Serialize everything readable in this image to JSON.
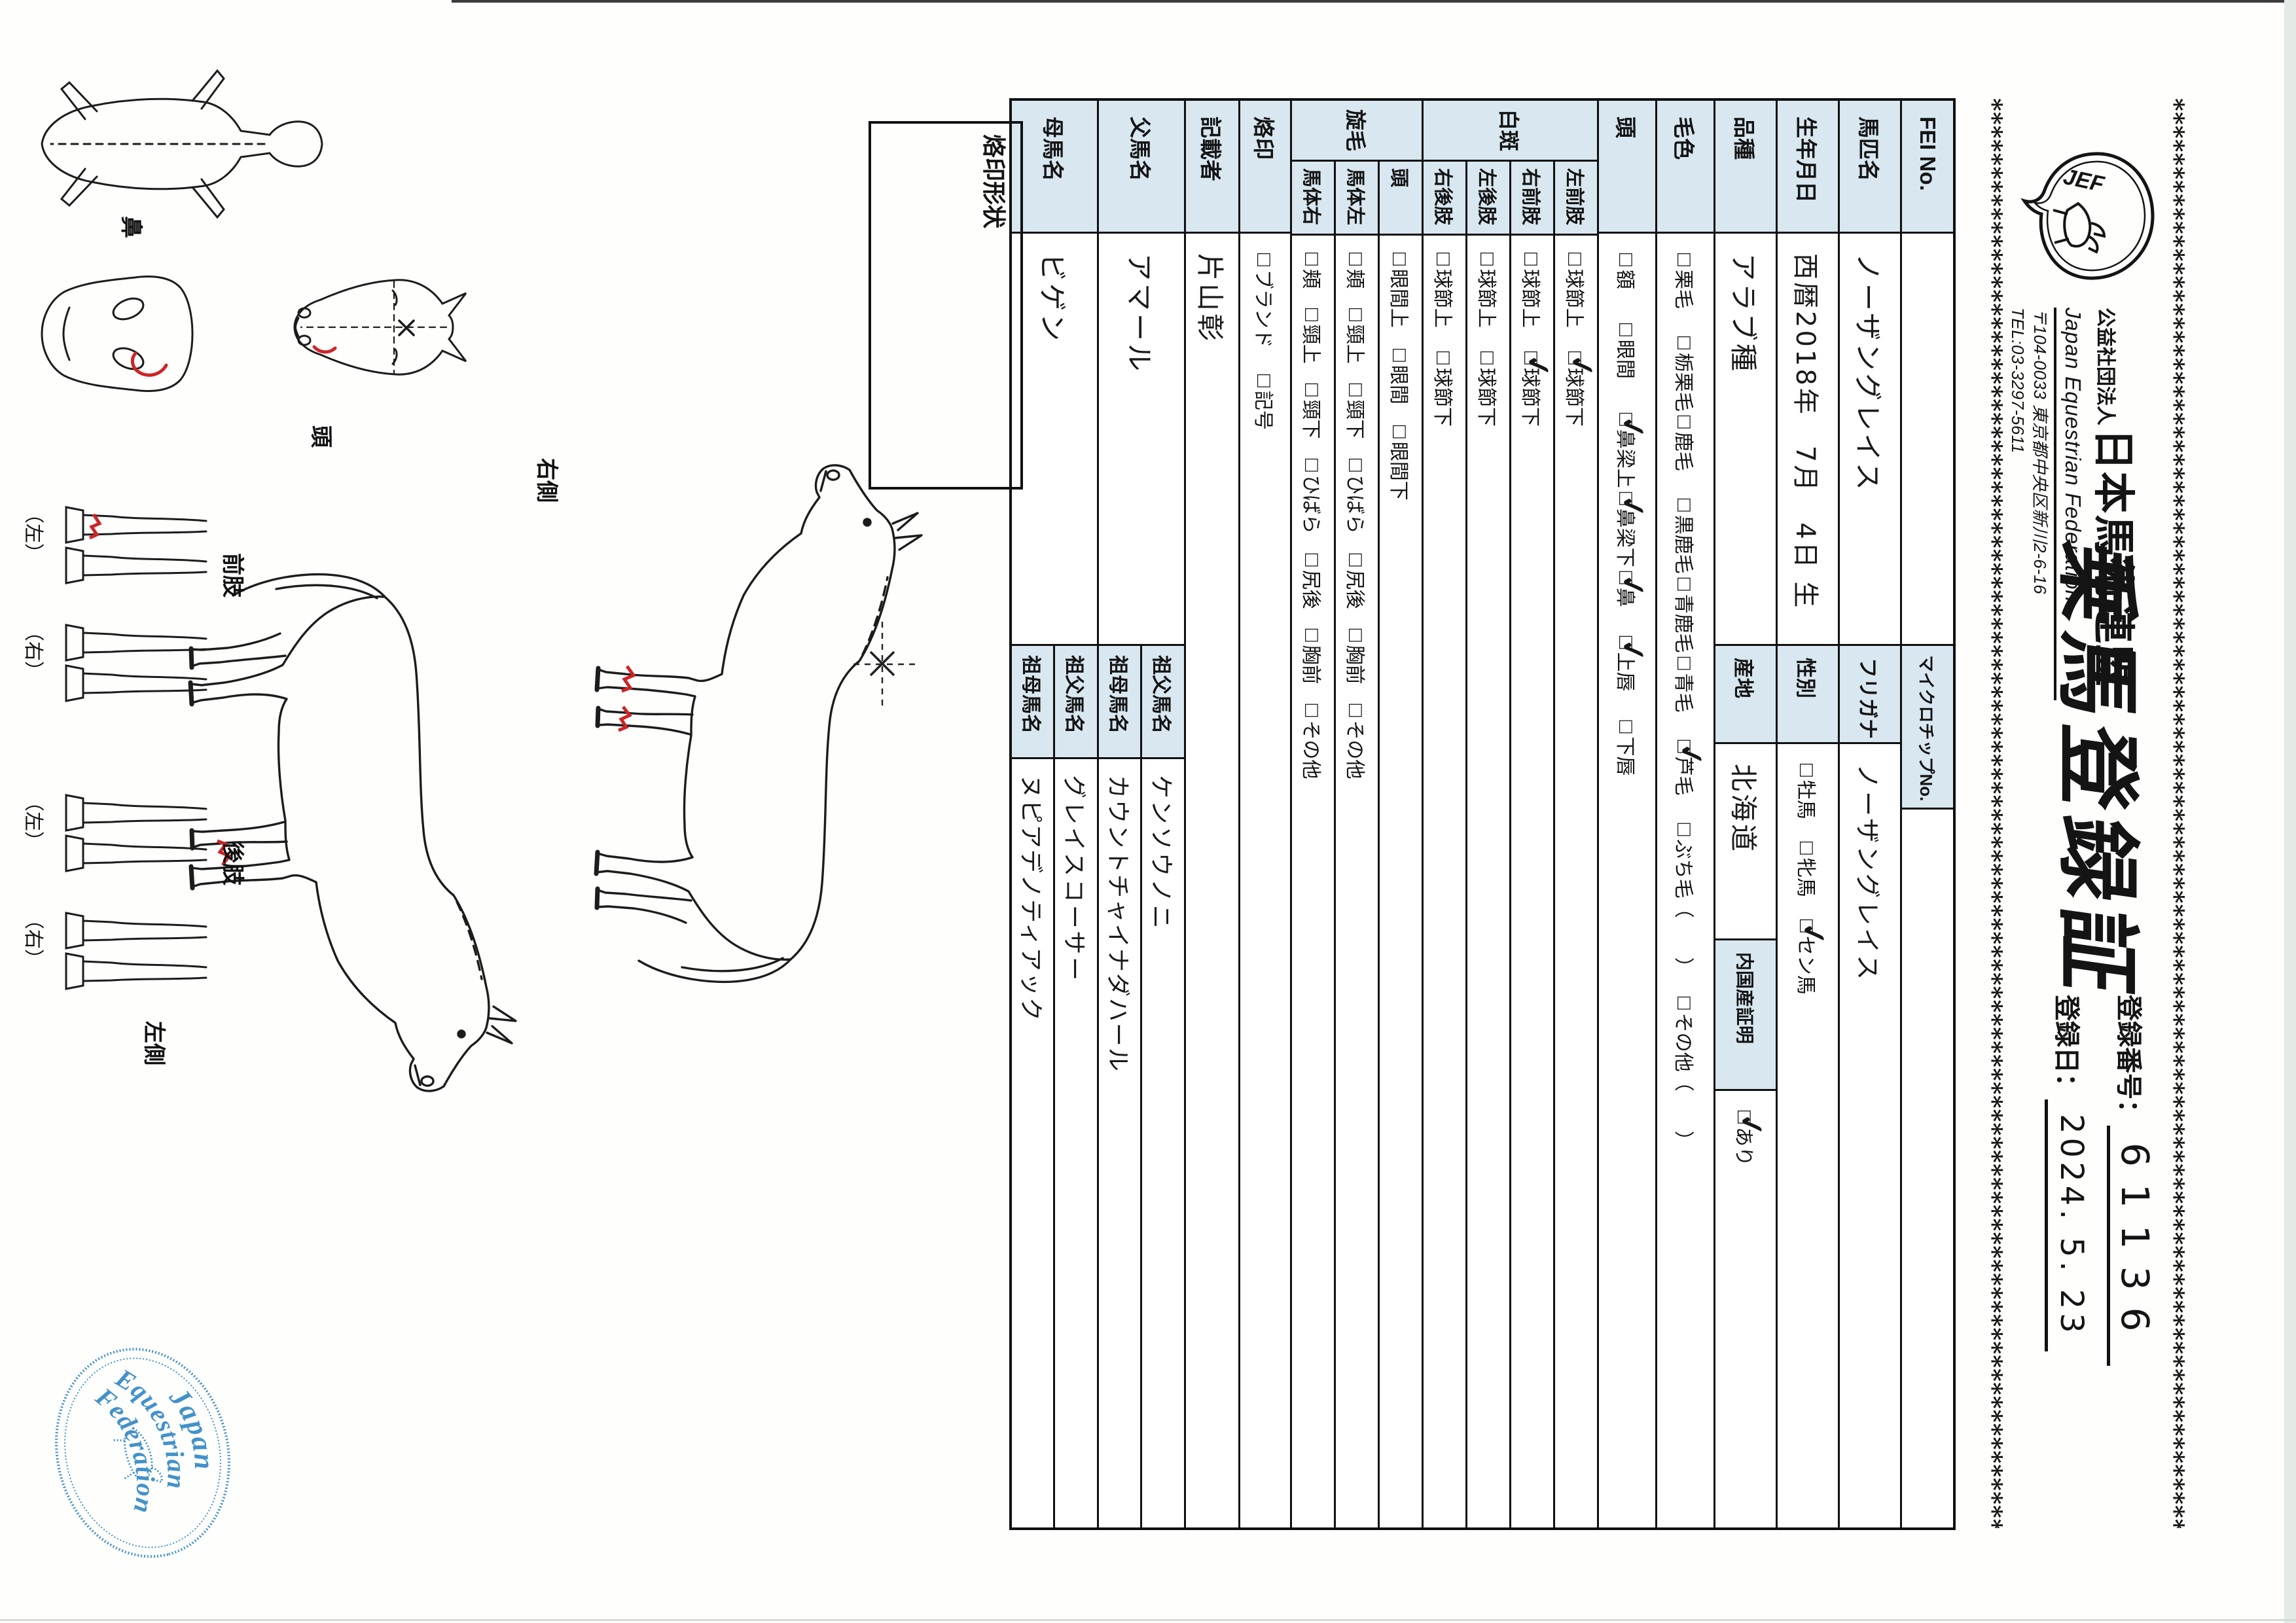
{
  "colors": {
    "label_bg": "#d8e7f0",
    "border": "#101010",
    "stamp_blue": "#2e86c5",
    "red_mark": "#cc2527"
  },
  "header": {
    "asterisk_row": "*************************************************************************************************************************************",
    "org_prefix": "公益社団法人",
    "org_name": "日本馬術連盟",
    "org_en": "Japan Equestrian Federation",
    "org_addr": "〒104-0033 東京都中央区新川2-6-16",
    "org_tel": "TEL:03-3297-5611",
    "logo_text": "JEF",
    "title": "乗馬登録証",
    "reg_no_label": "登録番号：",
    "reg_no": "61136",
    "reg_date_label": "登録日：",
    "reg_date": "2024. 5. 23"
  },
  "table": {
    "fei": {
      "label": "FEI No.",
      "value": "",
      "chip_label": "マイクロチップNo.",
      "chip_value": ""
    },
    "name": {
      "label": "馬匹名",
      "value": "ノーザングレイス",
      "kana_label": "フリガナ",
      "kana": "ノーザングレイス"
    },
    "birth": {
      "label": "生年月日",
      "value": "西暦2018年　7月　4日 生",
      "sex_label": "性別",
      "sex_options": [
        {
          "t": "牡馬",
          "c": false,
          "g": 34
        },
        {
          "t": "牝馬",
          "c": false,
          "g": 34
        },
        {
          "t": "セン馬",
          "c": true,
          "g": 0
        }
      ]
    },
    "breed": {
      "label": "品種",
      "value": "アラブ種",
      "origin_label": "産地",
      "origin": "北海道",
      "domestic_label": "内国産証明",
      "domestic_options": [
        {
          "t": "あり",
          "c": true,
          "g": 0
        }
      ]
    },
    "coat": {
      "label": "毛色",
      "options": [
        {
          "t": "栗毛",
          "c": false,
          "g": 42
        },
        {
          "t": "栃栗毛",
          "c": false,
          "g": 6
        },
        {
          "t": "鹿毛",
          "c": false,
          "g": 42
        },
        {
          "t": "黒鹿毛",
          "c": false,
          "g": 6
        },
        {
          "t": "青鹿毛",
          "c": false,
          "g": 6
        },
        {
          "t": "青毛",
          "c": false,
          "g": 42
        },
        {
          "t": "芦毛",
          "c": true,
          "g": 42
        },
        {
          "t": "ぶち毛（　　）",
          "c": false,
          "g": 30
        },
        {
          "t": "その他（　　）",
          "c": false,
          "g": 0
        }
      ]
    },
    "head": {
      "label": "頭",
      "options": [
        {
          "t": "額",
          "c": false,
          "g": 52
        },
        {
          "t": "眼間",
          "c": false,
          "g": 52
        },
        {
          "t": "鼻梁上",
          "c": true,
          "g": 6
        },
        {
          "t": "鼻梁下",
          "c": true,
          "g": 6
        },
        {
          "t": "鼻",
          "c": true,
          "g": 44
        },
        {
          "t": "上唇",
          "c": true,
          "g": 44
        },
        {
          "t": "下唇",
          "c": false,
          "g": 0
        }
      ]
    },
    "hakuhan": {
      "label": "白斑",
      "rows": [
        {
          "label": "左前肢",
          "options": [
            {
              "t": "球節上",
              "c": false,
              "g": 36
            },
            {
              "t": "球節下",
              "c": true,
              "g": 0
            }
          ]
        },
        {
          "label": "右前肢",
          "options": [
            {
              "t": "球節上",
              "c": false,
              "g": 36
            },
            {
              "t": "球節下",
              "c": true,
              "g": 0
            }
          ]
        },
        {
          "label": "左後肢",
          "options": [
            {
              "t": "球節上",
              "c": false,
              "g": 36
            },
            {
              "t": "球節下",
              "c": false,
              "g": 0
            }
          ]
        },
        {
          "label": "右後肢",
          "options": [
            {
              "t": "球節上",
              "c": false,
              "g": 36
            },
            {
              "t": "球節下",
              "c": false,
              "g": 0
            }
          ]
        }
      ]
    },
    "senmou": {
      "label": "旋毛",
      "rows": [
        {
          "label": "頭",
          "options": [
            {
              "t": "眼間上",
              "c": false,
              "g": 32
            },
            {
              "t": "眼間",
              "c": false,
              "g": 32
            },
            {
              "t": "眼間下",
              "c": false,
              "g": 0
            }
          ]
        },
        {
          "label": "馬体左",
          "options": [
            {
              "t": "頬",
              "c": false,
              "g": 30
            },
            {
              "t": "頸上",
              "c": false,
              "g": 30
            },
            {
              "t": "頸下",
              "c": false,
              "g": 30
            },
            {
              "t": "ひばら",
              "c": false,
              "g": 30
            },
            {
              "t": "尻後",
              "c": false,
              "g": 30
            },
            {
              "t": "胸前",
              "c": false,
              "g": 30
            },
            {
              "t": "その他",
              "c": false,
              "g": 0
            }
          ]
        },
        {
          "label": "馬体右",
          "options": [
            {
              "t": "頬",
              "c": false,
              "g": 30
            },
            {
              "t": "頸上",
              "c": false,
              "g": 30
            },
            {
              "t": "頸下",
              "c": false,
              "g": 30
            },
            {
              "t": "ひばら",
              "c": false,
              "g": 30
            },
            {
              "t": "尻後",
              "c": false,
              "g": 30
            },
            {
              "t": "胸前",
              "c": false,
              "g": 30
            },
            {
              "t": "その他",
              "c": false,
              "g": 0
            }
          ]
        }
      ]
    },
    "rakuin": {
      "label": "烙印",
      "options": [
        {
          "t": "ブランド",
          "c": false,
          "g": 40
        },
        {
          "t": "記号",
          "c": false,
          "g": 0
        }
      ]
    },
    "recorder": {
      "label": "記載者",
      "value": "片山彰"
    },
    "sire": {
      "label": "父馬名",
      "value": "アマール",
      "gsire_label": "祖父馬名",
      "gsire": "ケンソウノニ",
      "gdam_label": "祖母馬名",
      "gdam": "カウントチャイナダハール"
    },
    "dam": {
      "label": "母馬名",
      "value": "ビゲン",
      "gsire_label": "祖父馬名",
      "gsire": "グレイスコーサー",
      "gdam_label": "祖母馬名",
      "gdam": "ヌピアデノティアック"
    }
  },
  "diagram": {
    "brand_box_label": "烙印形状",
    "right_side": "右側",
    "left_side": "左側",
    "head": "頭",
    "nose": "鼻",
    "front_limbs": "前肢",
    "hind_limbs": "後肢",
    "left_paren": "（左）",
    "right_paren": "（右）"
  },
  "stamp": {
    "line1": "Japan",
    "line2": "Equestrian",
    "line3": "Federation"
  }
}
